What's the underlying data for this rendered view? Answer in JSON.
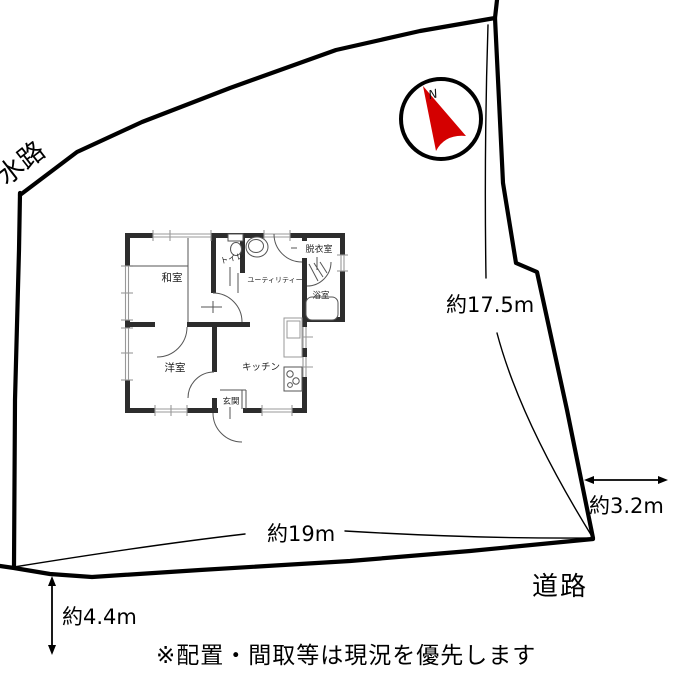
{
  "site": {
    "waterway_label": "水路",
    "road_label": "道路",
    "dim_right": "約17.5m",
    "dim_bottom": "約19m",
    "dim_road_width": "約3.2m",
    "dim_left_offset": "約4.4m",
    "note": "※配置・間取等は現況を優先します"
  },
  "compass": {
    "north_label": "N",
    "arrow_color": "#d40000"
  },
  "floor_plan": {
    "rooms": [
      {
        "id": "washitsu",
        "label": "和室"
      },
      {
        "id": "toilet",
        "label": "トイレ"
      },
      {
        "id": "utility",
        "label": "ユーティリティー"
      },
      {
        "id": "dressing_room",
        "label": "脱衣室"
      },
      {
        "id": "bathroom",
        "label": "浴室"
      },
      {
        "id": "western_room",
        "label": "洋室"
      },
      {
        "id": "kitchen",
        "label": "キッチン"
      },
      {
        "id": "entrance",
        "label": "玄関"
      }
    ]
  },
  "colors": {
    "boundary": "#000000",
    "wall": "#2d2d2d",
    "thin_line": "#555555",
    "window_line": "#999999",
    "arrow_red": "#d40000"
  }
}
